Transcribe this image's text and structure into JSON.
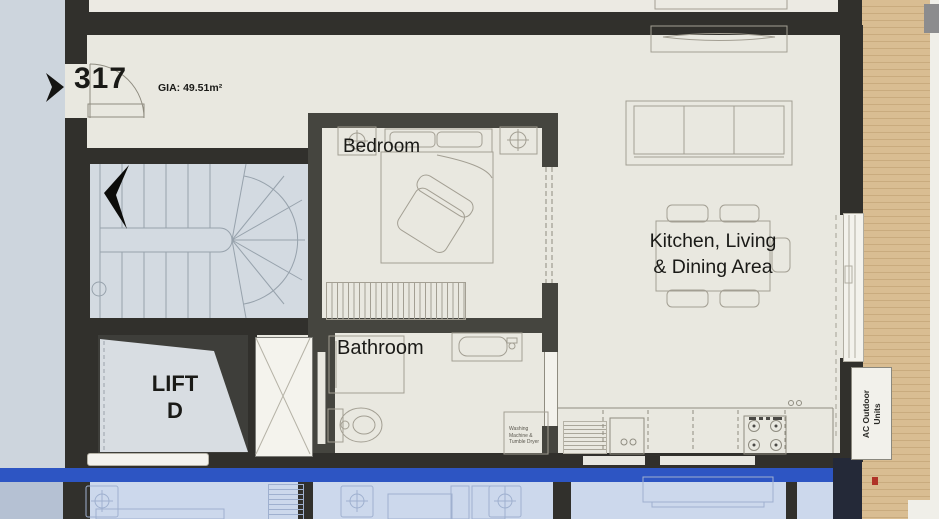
{
  "plan": {
    "unit_number": "317",
    "gia": "GIA: 49.51m²",
    "rooms": {
      "bedroom": "Bedroom",
      "bathroom": "Bathroom",
      "living_line1": "Kitchen, Living",
      "living_line2": "& Dining Area"
    },
    "lift_line1": "LIFT",
    "lift_line2": "D",
    "ac_line1": "AC Outdoor",
    "ac_line2": "Units",
    "washer_line1": "Washing",
    "washer_line2": "Machine &",
    "washer_line3": "Tumble Dryer"
  },
  "colors": {
    "floor_cream": "#e9e8e0",
    "wall_dark": "#31302c",
    "wall_partition": "#45453f",
    "corridor_blue": "#cdd5dd",
    "stair_floor": "#d3dae1",
    "lift_shaft": "#3e3e3a",
    "lift_car": "#d8dde2",
    "wood_deck": "#d9bd92",
    "level_band_blue": "#2d55c3",
    "lower_floor_blue": "#ccd8ec"
  }
}
